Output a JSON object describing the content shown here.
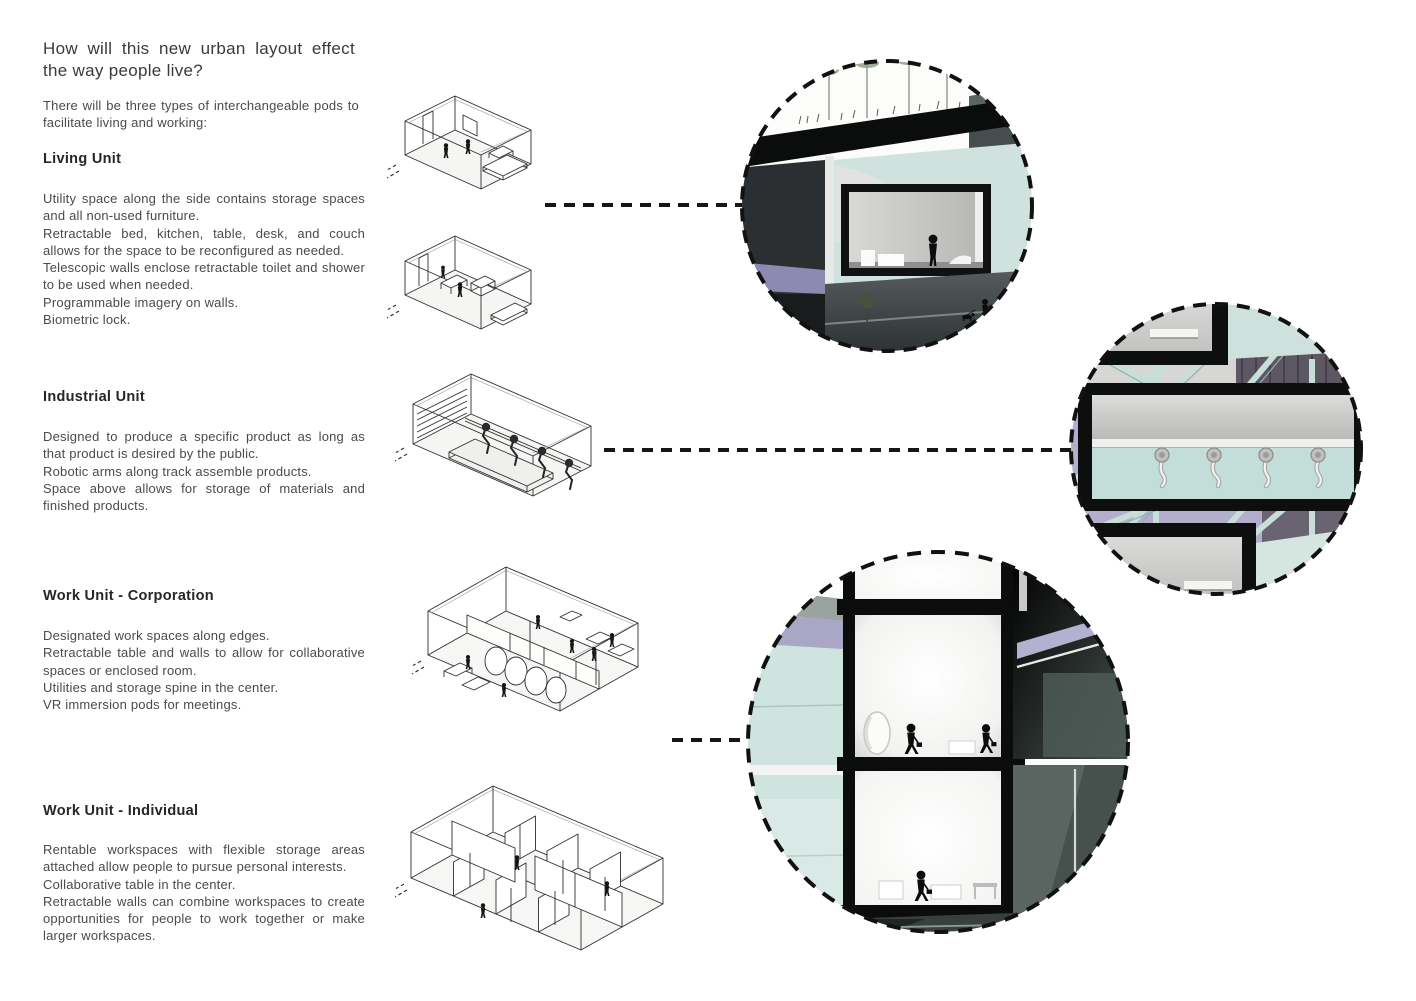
{
  "header": {
    "question": "How will this new urban layout effect the way people live?",
    "intro": "There will be three types of interchangeable pods to facilitate living and working:"
  },
  "sections": [
    {
      "id": "living-unit",
      "title": "Living Unit",
      "lines": [
        "Utility space along the side contains storage spaces and all non-used furniture.",
        "Retractable bed, kitchen, table, desk, and couch allows for the space to be reconfigured as needed.",
        "Telescopic walls enclose retractable toilet and shower to be used when needed.",
        "Programmable imagery on walls.",
        "Biometric lock."
      ]
    },
    {
      "id": "industrial-unit",
      "title": "Industrial Unit",
      "lines": [
        "Designed to produce a specific product as long as that product is desired by the public.",
        "Robotic arms along track assemble products.",
        "Space above allows for storage of materials and finished products."
      ]
    },
    {
      "id": "work-unit-corporation",
      "title": "Work Unit - Corporation",
      "lines": [
        "Designated work spaces along edges.",
        "Retractable table and walls to allow for collaborative spaces or enclosed room.",
        "Utilities and storage spine in the center.",
        "VR immersion pods for meetings."
      ]
    },
    {
      "id": "work-unit-individual",
      "title": "Work Unit - Individual",
      "lines": [
        "Rentable workspaces with flexible storage areas attached allow people to pursue personal interests.",
        "Collaborative table in the center.",
        "Retractable walls can combine workspaces to create opportunities for people to work together or make larger workspaces."
      ]
    }
  ],
  "figures": {
    "drawings": [
      "living-unit-pod-a-isometric",
      "living-unit-pod-b-isometric",
      "industrial-unit-pod-isometric",
      "work-unit-corporation-pod-isometric",
      "work-unit-individual-pod-isometric"
    ],
    "renders": [
      "living-unit-section-render",
      "industrial-unit-section-render",
      "work-unit-section-render"
    ],
    "connectors": [
      "living-dashed-connector",
      "industrial-dashed-connector",
      "work-dashed-connector"
    ]
  },
  "colors": {
    "mint": "#cfe3df",
    "teal_band": "#c3ddd8",
    "lavender": "#a9a6c4",
    "dark_mass": "#24282a",
    "mid_gray": "#4c5456",
    "frame_black": "#0d0e0e",
    "line_art": "#2f2f2f",
    "text": "#4a4a4a",
    "heading": "#262626"
  }
}
